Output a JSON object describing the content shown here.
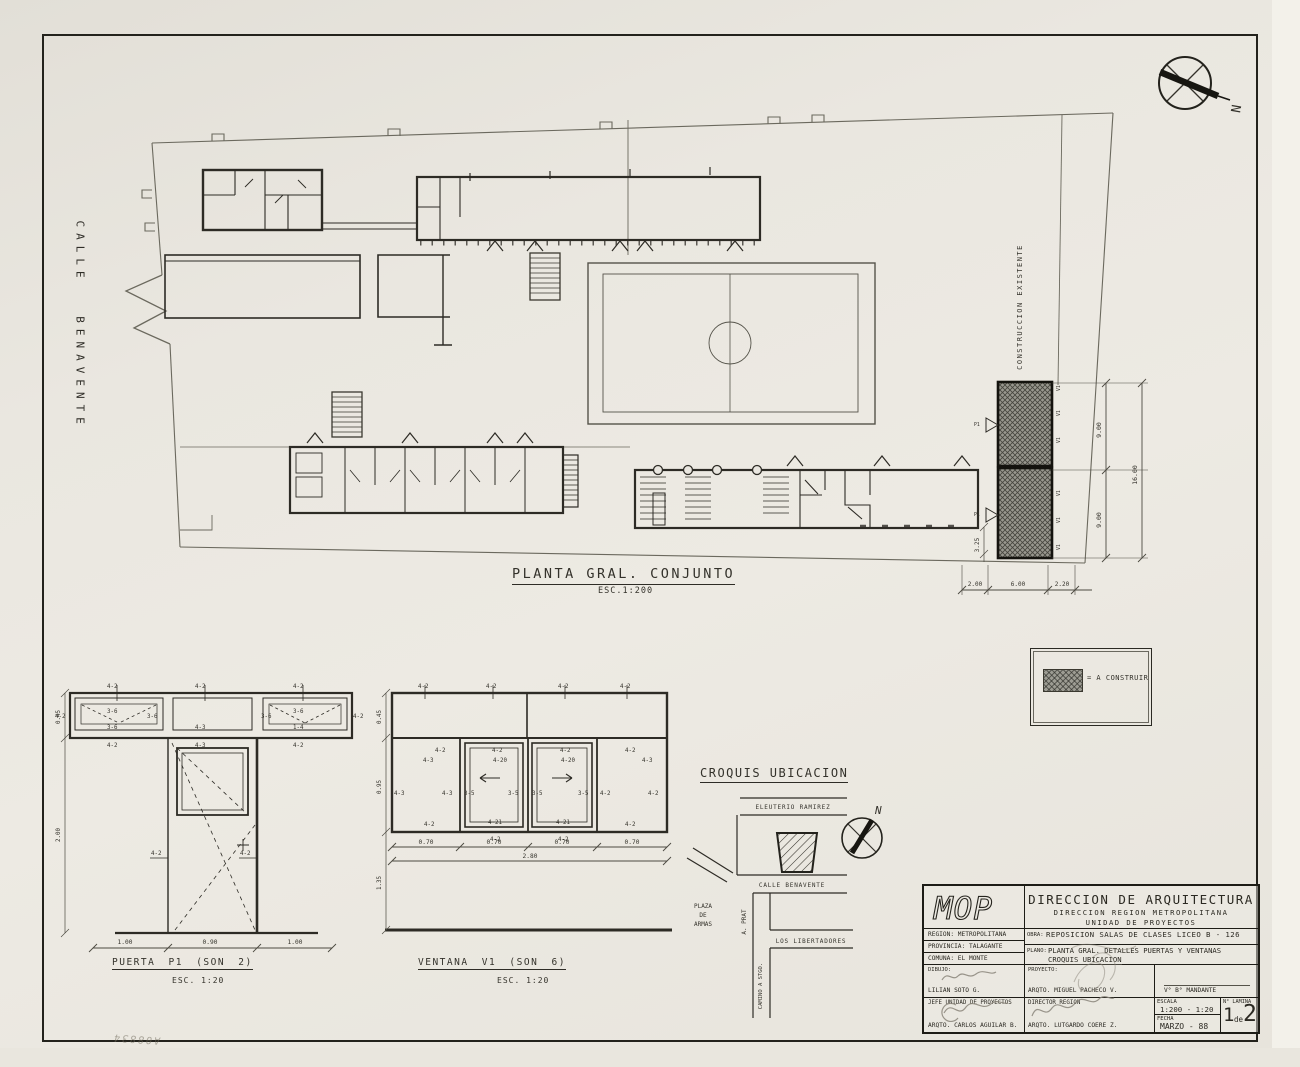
{
  "paper": {
    "note": "A08834"
  },
  "compass": {
    "n": "N"
  },
  "streets_left_label": "CALLE BENAVENTE",
  "plan": {
    "title": "PLANTA GRAL. CONJUNTO",
    "scale": "ESC.1:200",
    "existing": "CONSTRUCCION EXISTENTE",
    "mark_v1": "V1",
    "mark_p1": "P1"
  },
  "dims": {
    "d045": "0.45",
    "d070": "0.70",
    "d090": "0.90",
    "d095": "0.95",
    "d100": "1.00",
    "d135": "1.35",
    "d200": "2.00",
    "d220": "2.20",
    "d280": "2.80",
    "d325": "3.25",
    "d600": "6.00",
    "d900": "9.00",
    "d1600": "16.00"
  },
  "tags": {
    "t42": "4-2",
    "t36": "3-6",
    "t35": "3-5",
    "t43": "4-3",
    "t14": "1-4",
    "t420": "4-20",
    "t421": "4-21"
  },
  "legend": {
    "equals": "= A CONSTRUIR"
  },
  "puerta": {
    "title": "PUERTA P1 (SON 2)",
    "scale": "ESC. 1:20"
  },
  "ventana": {
    "title": "VENTANA V1 (SON 6)",
    "scale": "ESC. 1:20"
  },
  "croquis": {
    "title": "CROQUIS UBICACION",
    "eleuterio": "ELEUTERIO RAMIREZ",
    "benavente": "CALLE BENAVENTE",
    "prat": "A. PRAT",
    "libertadores": "LOS LIBERTADORES",
    "camino": "CAMINO A STGO.",
    "plaza1": "PLAZA",
    "plaza2": "DE",
    "plaza3": "ARMAS",
    "n": "N"
  },
  "titleblock": {
    "mop": "MOP",
    "agency1": "DIRECCION DE ARQUITECTURA",
    "agency2": "DIRECCION REGION METROPOLITANA",
    "agency3": "UNIDAD DE PROYECTOS",
    "region": "REGION: METROPOLITANA",
    "provincia": "PROVINCIA: TALAGANTE",
    "comuna": "COMUNA: EL MONTE",
    "obra_label": "OBRA:",
    "obra": "REPOSICION SALAS DE CLASES LICEO B - 126",
    "plano_label": "PLANO:",
    "plano1": "PLANTA GRAL. DETALLES PUERTAS Y VENTANAS",
    "plano2": "CROQUIS UBICACION",
    "dibujo_label": "DIBUJO:",
    "dibujo": "LILIAN SOTO G.",
    "proyecto_label": "PROYECTO:",
    "proyecto": "ARQTO. MIGUEL PACHECO V.",
    "vb": "V° B° MANDANTE",
    "jefe_label": "JEFE UNIDAD DE PROYECTOS",
    "jefe": "ARQTO. CARLOS AGUILAR B.",
    "director_label": "DIRECTOR REGION",
    "director": "ARQTO. LUTGARDO COERE Z.",
    "escala_label": "ESCALA",
    "escala": "1:200 - 1:20",
    "fecha_label": "FECHA",
    "fecha": "MARZO - 88",
    "lamina_label": "N° LAMINA",
    "lamina1": "1",
    "lamina_de": "de",
    "lamina2": "2"
  }
}
